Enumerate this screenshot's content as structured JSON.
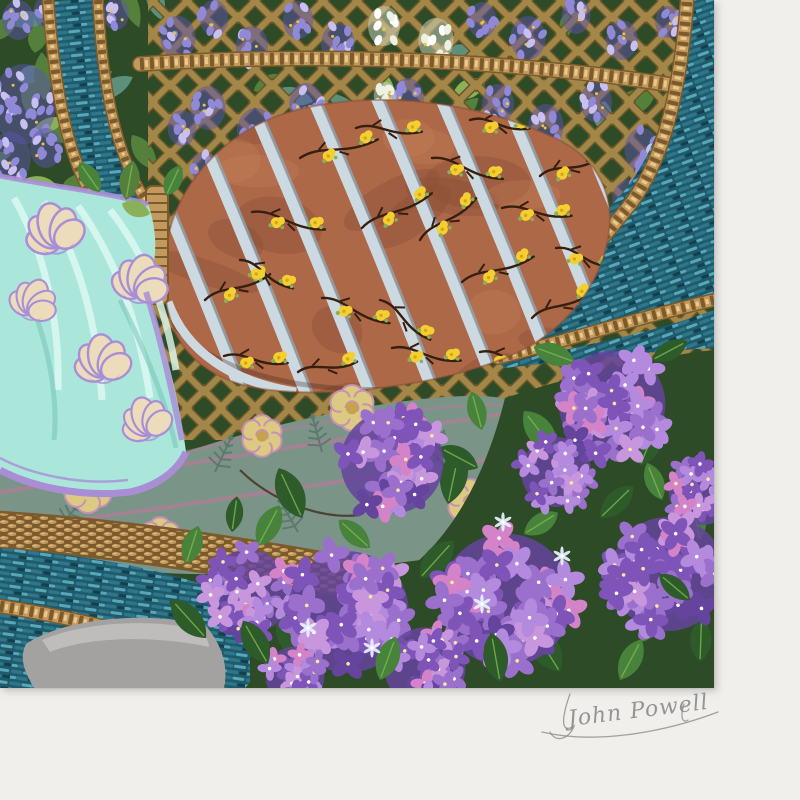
{
  "painting": {
    "signature": "John Powell"
  },
  "palette": {
    "matte": "#f0efec",
    "matteShadow": "#cfcdc8",
    "tealDark": "#1e5a6c",
    "tealMid": "#2f7689",
    "tealLight": "#58a7b8",
    "tealDeep": "#143f4d",
    "ropeTan": "#c39a5e",
    "ropeDark": "#7b5a2b",
    "ropeLight": "#ecc98b",
    "latticeTan": "#a28748",
    "latticeShadow": "#6b5527",
    "foliageDark": "#2e4b27",
    "foliageMid": "#55803c",
    "leafLight": "#8bb05a",
    "tealLeaf": "#5d907c",
    "wisteria": "#9089d8",
    "wisteriaDark": "#5c54ac",
    "wisteriaLight": "#c9c0f2",
    "bloomWhite": "#edf1e2",
    "flowerDot": "#e9c83f",
    "cushion": "#ad6847",
    "cushionDark": "#8a4e37",
    "cushionLight": "#c68258",
    "ribbon": "#cdd9e1",
    "ribbonShadow": "#8ea8ba",
    "flowerYellow": "#f3cf30",
    "flowerYellowDeep": "#d8a517",
    "branch": "#371f0e",
    "aqua": "#aae7da",
    "aquaLight": "#e0faf4",
    "aquaShadow": "#6fbfb6",
    "trim": "#a98ed6",
    "cream": "#ecdcbc",
    "sage": "#7b9488",
    "sageDark": "#5e796d",
    "roseCream": "#dcc982",
    "roseCore": "#c5a24e",
    "rosePink": "#c791b5",
    "pipingMauve": "#aa8095",
    "hyd1": "#9a70cc",
    "hyd2": "#7e54b8",
    "hyd3": "#b48ade",
    "hyd4": "#c896dc",
    "hyd5": "#64449c",
    "hydPink": "#d583c8",
    "leafDark": "#2d5b2a",
    "leafMid": "#47833b",
    "leafVein": "#82b551",
    "stone": "#a3a2a0",
    "stoneLight": "#c3c2bf",
    "signature": "#8d8d8d"
  }
}
